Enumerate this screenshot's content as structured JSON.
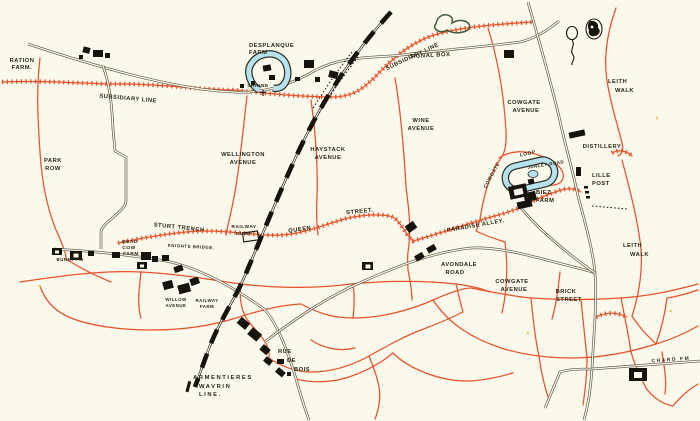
{
  "map": {
    "colors": {
      "background": "#fbf8ec",
      "trench": "#e8532a",
      "road": "#57503a",
      "railway": "#17140e",
      "building": "#17140e",
      "water_fill": "#b5e2ec",
      "water_outline": "#33302a",
      "pond_outline": "#3c5c3c",
      "label": "#2b2817",
      "speck": "#e9c94f"
    },
    "icons": {
      "balloons": "observation-balloon-icons",
      "pond": "pond-outline",
      "shrine_cross": "shrine-cross",
      "moats": "farm-moat-water"
    },
    "labels": {
      "ration_farm": [
        "RATION",
        "FARM."
      ],
      "subsidiary_line_w": "SUBSIDIARY LINE",
      "subsidiary_line_e": "SUBSIDIARY LINE",
      "desplanque_farm": [
        "DESPLANQUE",
        "FARM"
      ],
      "shrine": "SHRINE",
      "signal_box": "SIGNAL BOX",
      "park_row": [
        "PARK",
        "ROW"
      ],
      "wellington_avenue": [
        "WELLINGTON",
        "AVENUE"
      ],
      "haystack_avenue": [
        "HAYSTACK",
        "AVENUE"
      ],
      "wine_avenue": [
        "WINE",
        "AVENUE"
      ],
      "cowgate_avenue_n": [
        "COWGATE",
        "AVENUE"
      ],
      "leith_walk_n": [
        "LEITH",
        "WALK"
      ],
      "distillery": "DISTILLERY",
      "lille_post": [
        "LILLE",
        "POST"
      ],
      "sturt_trench": "STURT TRENCH",
      "railway_dump": [
        "RAILWAY",
        "DUMP"
      ],
      "queen_street": [
        "QUEEN",
        "STREET."
      ],
      "dead_cow_farm": [
        "DEAD",
        "COW",
        "FARM"
      ],
      "knights_bridge": "KNIGHTS BRIDGE.",
      "burnt_fm": "BURNT FM",
      "cowgate_loop": "COWGATE",
      "loop": "LOOP",
      "junley_road": "JUNLEY ROAD",
      "biez_farm": [
        "BIEZ",
        "FARM"
      ],
      "paradise_alley": "PARADISE ALLEY.",
      "avondale_road": [
        "AVONDALE",
        "ROAD"
      ],
      "cowgate_avenue_s": [
        "COWGATE",
        "AVENUE"
      ],
      "brick_street": [
        "BRICK",
        "STREET"
      ],
      "leith_walk_s": [
        "LEITH",
        "WALK"
      ],
      "willow_avenue": [
        "WILLOW",
        "AVENUE"
      ],
      "railway_farm": [
        "RAILWAY",
        "FARM"
      ],
      "rue_de_bois": [
        "RUE",
        "DE",
        "BOIS"
      ],
      "armentieres_line": [
        "ARMENTIERES",
        "WAVRIN",
        "LINE."
      ],
      "chard_fm": "CHARD FM"
    }
  }
}
